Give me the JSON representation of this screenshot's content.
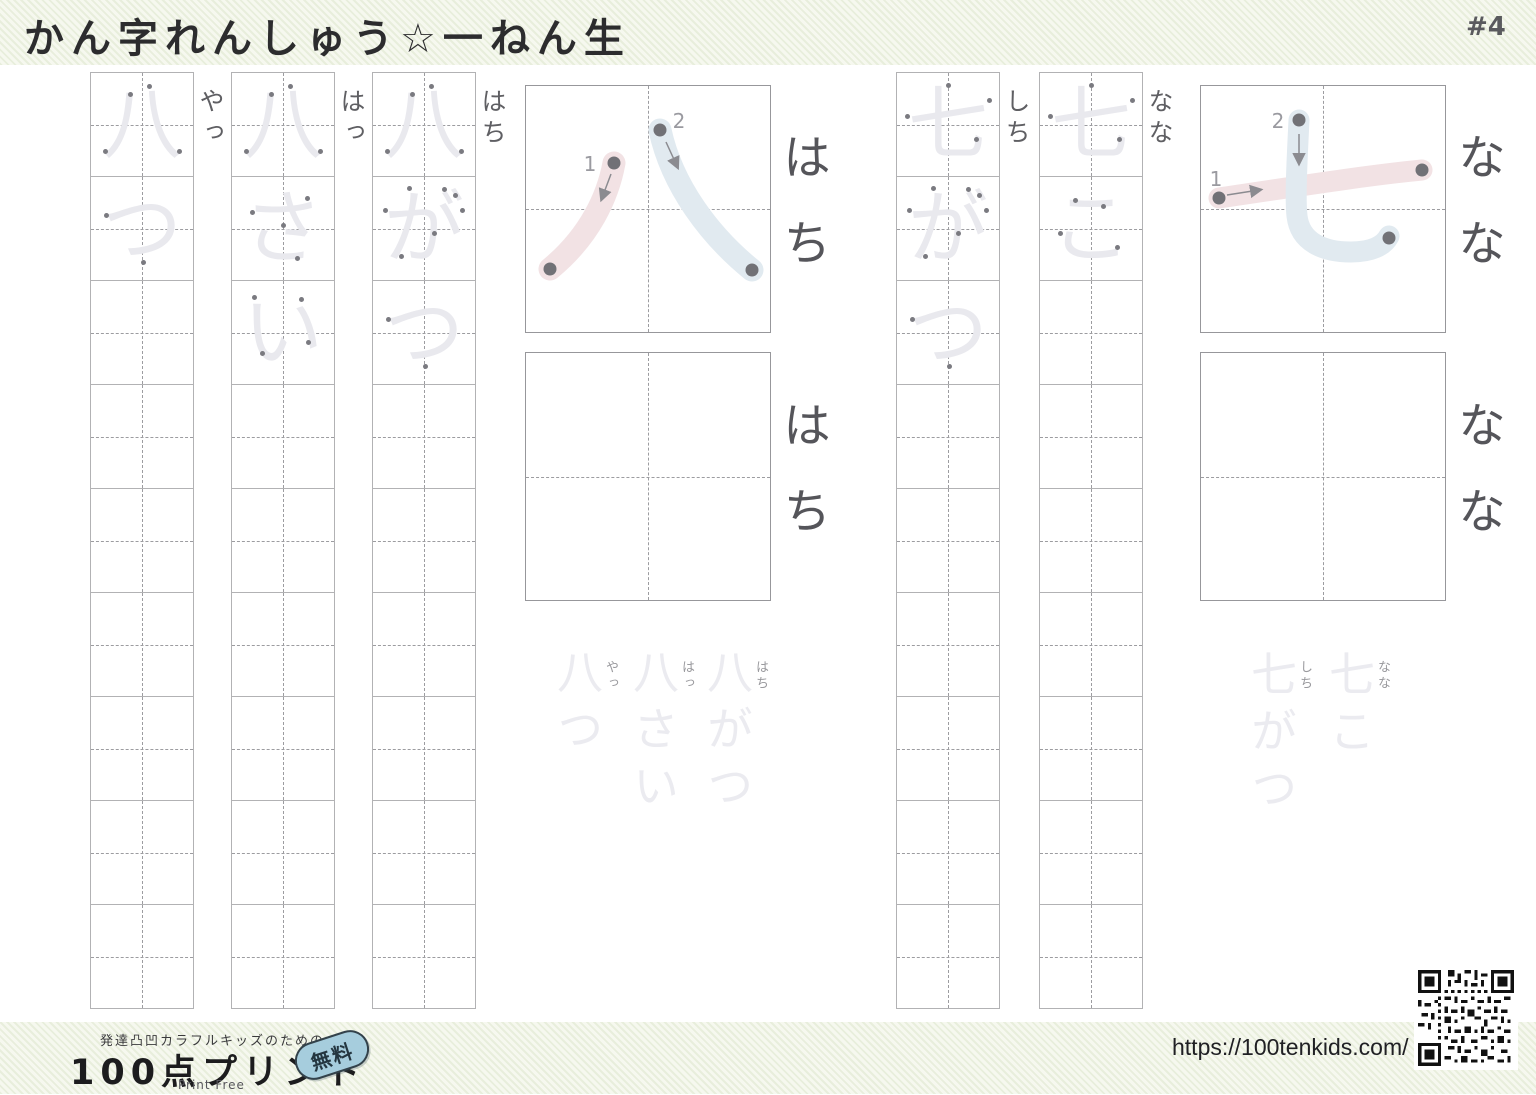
{
  "page": {
    "title": "かん字れんしゅう☆一ねん生",
    "number": "#4"
  },
  "sections": {
    "hachi": {
      "kanji": "八",
      "stroke_labels": [
        "1",
        "2"
      ],
      "example_reading": "はち",
      "practice_reading": "はち",
      "columns": [
        {
          "reading": "やっ",
          "cells": [
            "八",
            "つ"
          ]
        },
        {
          "reading": "はっ",
          "cells": [
            "八",
            "さ",
            "い"
          ]
        },
        {
          "reading": "はち",
          "cells": [
            "八",
            "が",
            "つ"
          ]
        }
      ],
      "examples": [
        {
          "word": "八つ",
          "furigana": "やっ"
        },
        {
          "word": "八さい",
          "furigana": "はっ"
        },
        {
          "word": "八がつ",
          "furigana": "はち"
        }
      ]
    },
    "shichi": {
      "kanji": "七",
      "stroke_labels": [
        "1",
        "2"
      ],
      "example_reading": "なな",
      "practice_reading": "なな",
      "columns": [
        {
          "reading": "しち",
          "cells": [
            "七",
            "が",
            "つ"
          ]
        },
        {
          "reading": "なな",
          "cells": [
            "七",
            "こ"
          ]
        }
      ],
      "examples": [
        {
          "word": "七がつ",
          "furigana": "しち"
        },
        {
          "word": "七こ",
          "furigana": "なな"
        }
      ]
    }
  },
  "footer": {
    "tagline": "発達凸凹カラフルキッズのための",
    "logo": "100点プリント",
    "badge": "無料",
    "print_free": "Print Free",
    "url": "https://100tenkids.com/"
  },
  "colors": {
    "stripe_green": "#e8eedc",
    "paper": "#ffffff",
    "grid_line": "#b2b2b4",
    "dash_guide": "#9c9ca0",
    "trace_gray": "#e9e9ee",
    "reading_gray": "#55555a",
    "stroke1_pink": "#f2e2e4",
    "stroke2_blue": "#e1eaf0",
    "dot_gray": "#717176",
    "stroke_number_gray": "#9a9aa0"
  },
  "trace_dots": {
    "八": [
      [
        36,
        18
      ],
      [
        12,
        74
      ],
      [
        55,
        11
      ],
      [
        84,
        74
      ]
    ],
    "七": [
      [
        8,
        40
      ],
      [
        88,
        24
      ],
      [
        48,
        10
      ],
      [
        75,
        62
      ]
    ],
    "つ": [
      [
        13,
        35
      ],
      [
        49,
        81
      ]
    ],
    "さ": [
      [
        18,
        32
      ],
      [
        72,
        18
      ],
      [
        48,
        45
      ],
      [
        62,
        77
      ]
    ],
    "い": [
      [
        20,
        14
      ],
      [
        27,
        68
      ],
      [
        66,
        16
      ],
      [
        73,
        57
      ]
    ],
    "が": [
      [
        10,
        30
      ],
      [
        33,
        9
      ],
      [
        25,
        75
      ],
      [
        58,
        52
      ],
      [
        68,
        10
      ],
      [
        78,
        16
      ],
      [
        85,
        30
      ]
    ],
    "こ": [
      [
        32,
        20
      ],
      [
        60,
        26
      ],
      [
        18,
        52
      ],
      [
        74,
        66
      ]
    ]
  }
}
